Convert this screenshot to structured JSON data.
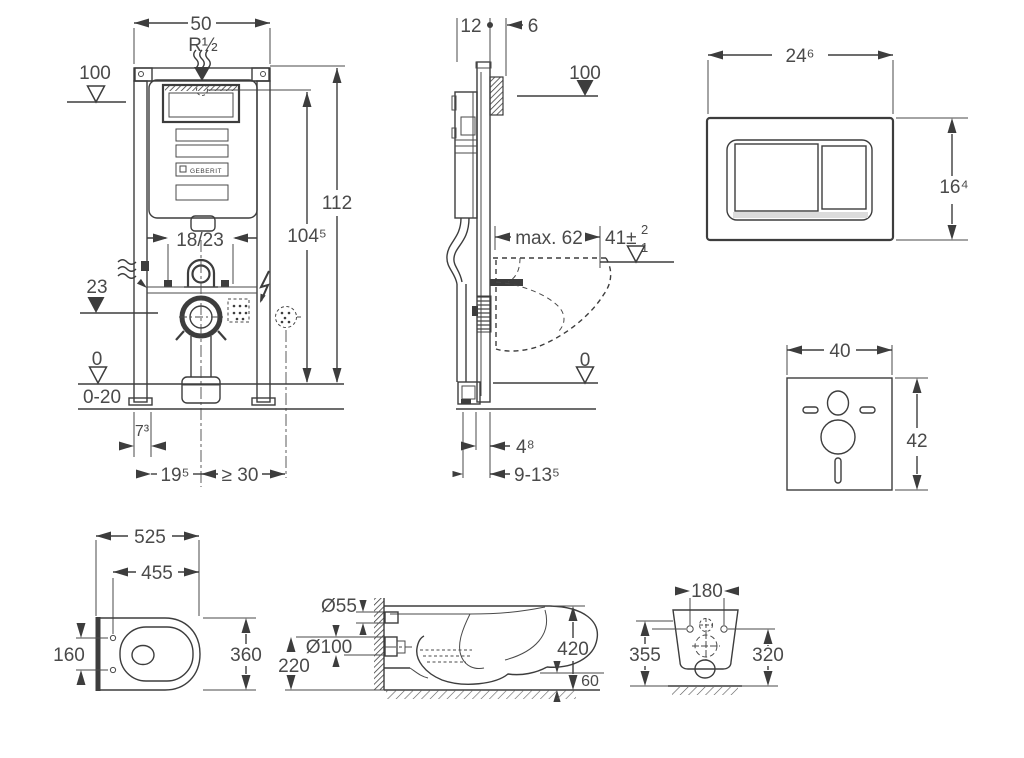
{
  "drawing": {
    "brand": "GEBERIT",
    "front": {
      "width": "50",
      "thread": "R½",
      "supply_level": "100",
      "total_height": "112",
      "inner_height": "104⁵",
      "flush_offset": "18/23",
      "outlet_level": "23",
      "zero_level": "0",
      "floor_range": "0-20",
      "foot_depth": "7³",
      "outlet_offset": "19⁵",
      "clearance": "≥ 30"
    },
    "side": {
      "depth": "12",
      "front_offset": "6",
      "supply_level": "100",
      "max_width": "max. 62",
      "rim_height": "41±",
      "rim_tol_plus": "2",
      "rim_tol_minus": "1",
      "zero_level": "0",
      "pipe_offset": "4⁸",
      "pipe_range": "9-13⁵"
    },
    "plate": {
      "width": "24⁶",
      "height": "16⁴"
    },
    "mat": {
      "width": "40",
      "height": "42"
    },
    "bowl_top": {
      "depth": "525",
      "seat_depth": "455",
      "holes": "160",
      "width": "360"
    },
    "bowl_side": {
      "inlet": "Ø55",
      "outlet": "Ø100",
      "outlet_height": "220",
      "height": "420",
      "gap": "60"
    },
    "bowl_rear": {
      "holes": "180",
      "left_height": "355",
      "right_height": "320"
    }
  }
}
